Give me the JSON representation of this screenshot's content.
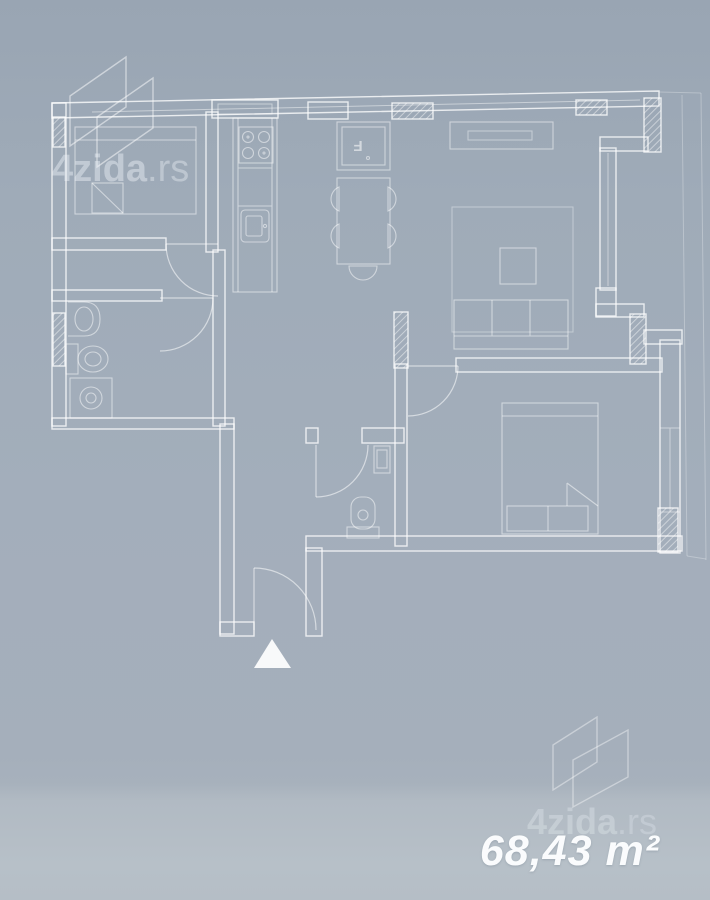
{
  "watermark": {
    "brand": "4zida",
    "tld": ".rs"
  },
  "labels": {
    "area": "68,43 m²",
    "fridge": "F"
  },
  "colors": {
    "background_top": "#99a5b3",
    "background_bottom": "#b7c0c8",
    "plan_line": "#ffffff"
  }
}
